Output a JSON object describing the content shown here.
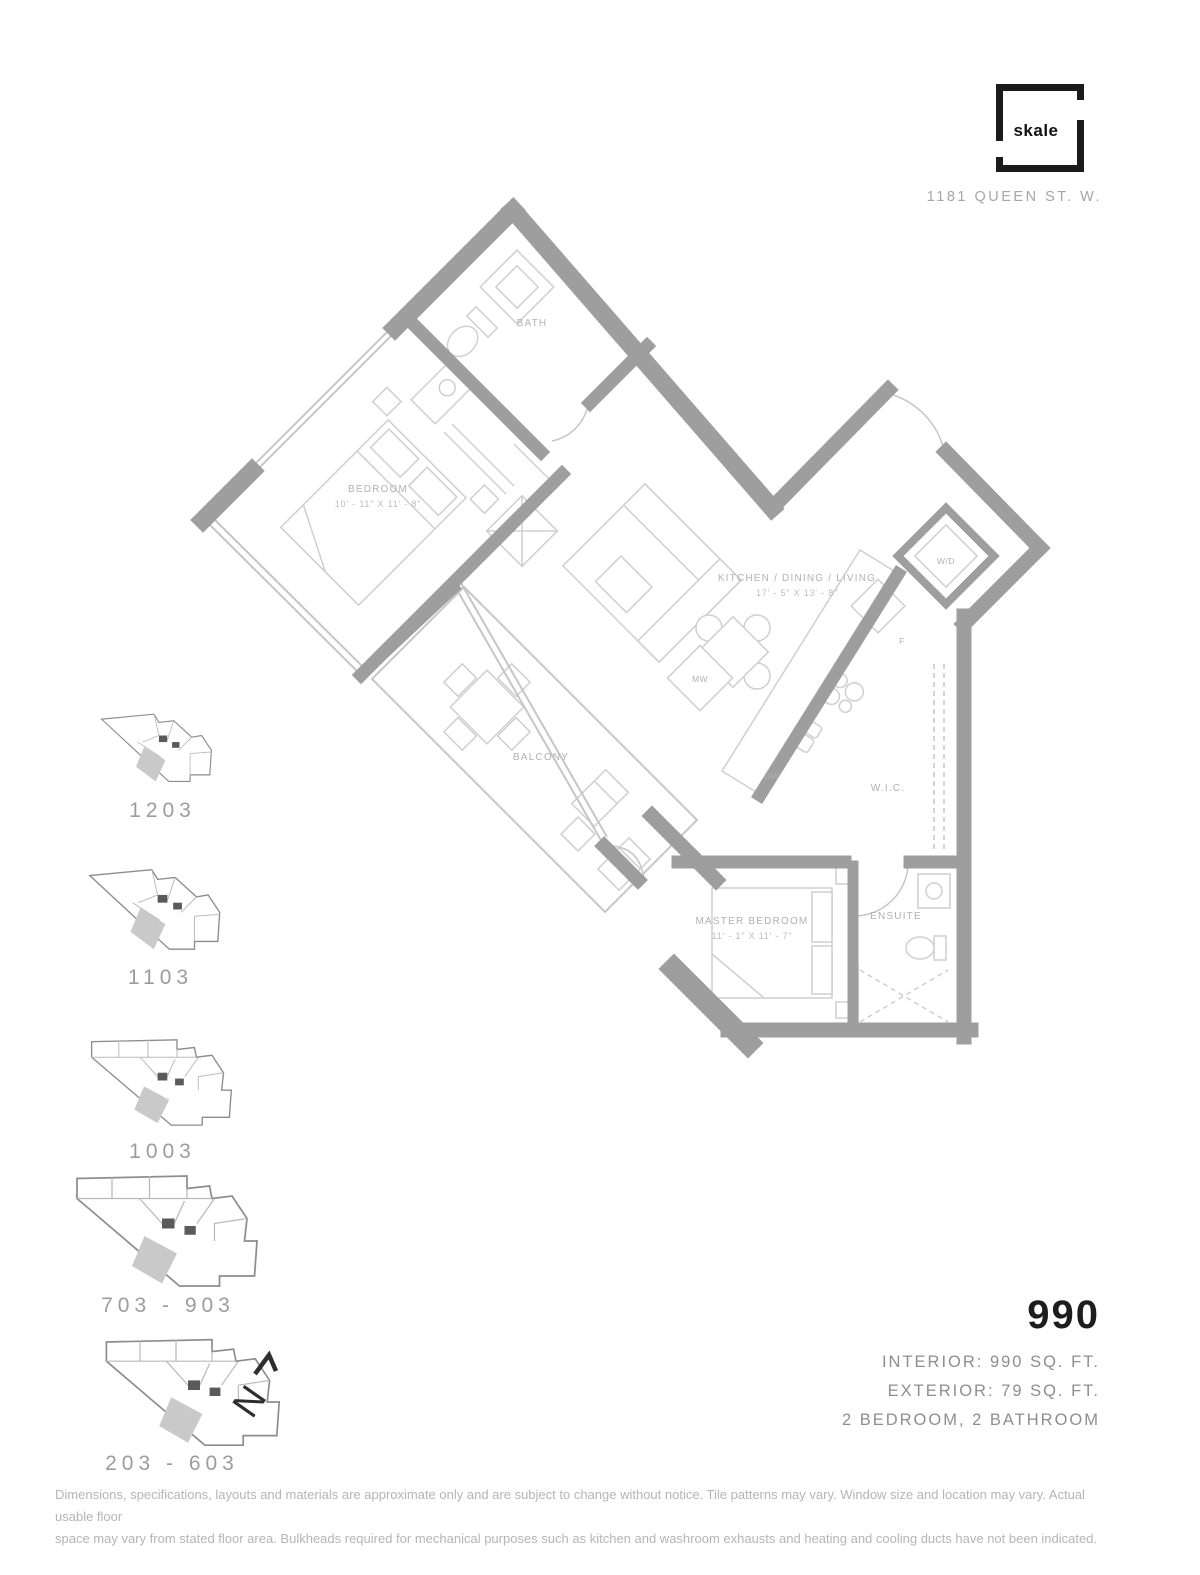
{
  "brand": {
    "logo_text": "skale",
    "address": "1181 QUEEN ST. W."
  },
  "floorplan": {
    "labels": {
      "bath": "BATH",
      "bedroom": "BEDROOM",
      "bedroom_dim": "10' - 11\" X 11' - 8\"",
      "kitchen": "KITCHEN / DINING / LIVING",
      "kitchen_dim": "17' - 5\" X 13' - 8\"",
      "balcony": "BALCONY",
      "master": "MASTER BEDROOM",
      "master_dim": "11' - 1\" X 11' - 7\"",
      "ensuite": "ENSUITE",
      "wic": "W.I.C.",
      "wd": "W/D",
      "mw": "MW",
      "dw": "DW",
      "fridge": "F"
    }
  },
  "keyplans": [
    {
      "label": "1203"
    },
    {
      "label": "1103"
    },
    {
      "label": "1003"
    },
    {
      "label": "703 - 903"
    },
    {
      "label": "203 - 603"
    }
  ],
  "north_label": "N",
  "unit": {
    "number": "990",
    "interior": "INTERIOR: 990 SQ. FT.",
    "exterior": "EXTERIOR: 79 SQ. FT.",
    "layout": "2 BEDROOM, 2 BATHROOM"
  },
  "disclaimer": {
    "line1": "Dimensions, specifications, layouts and materials are approximate only and are subject to change without notice. Tile patterns may vary. Window size and location may vary. Actual usable floor",
    "line2": "space may vary from stated floor area. Bulkheads required for mechanical purposes such as kitchen and washroom exhausts and heating and cooling ducts have not been indicated."
  },
  "colors": {
    "wall": "#9e9e9e",
    "thin_line": "#c6c6c6",
    "furniture": "#cfcfcf",
    "plan_label": "#b2b2b2",
    "keyplan_line": "#8d8d8d",
    "keyplan_fill": "#c9c9c9",
    "ink": "#1b1b1b"
  }
}
